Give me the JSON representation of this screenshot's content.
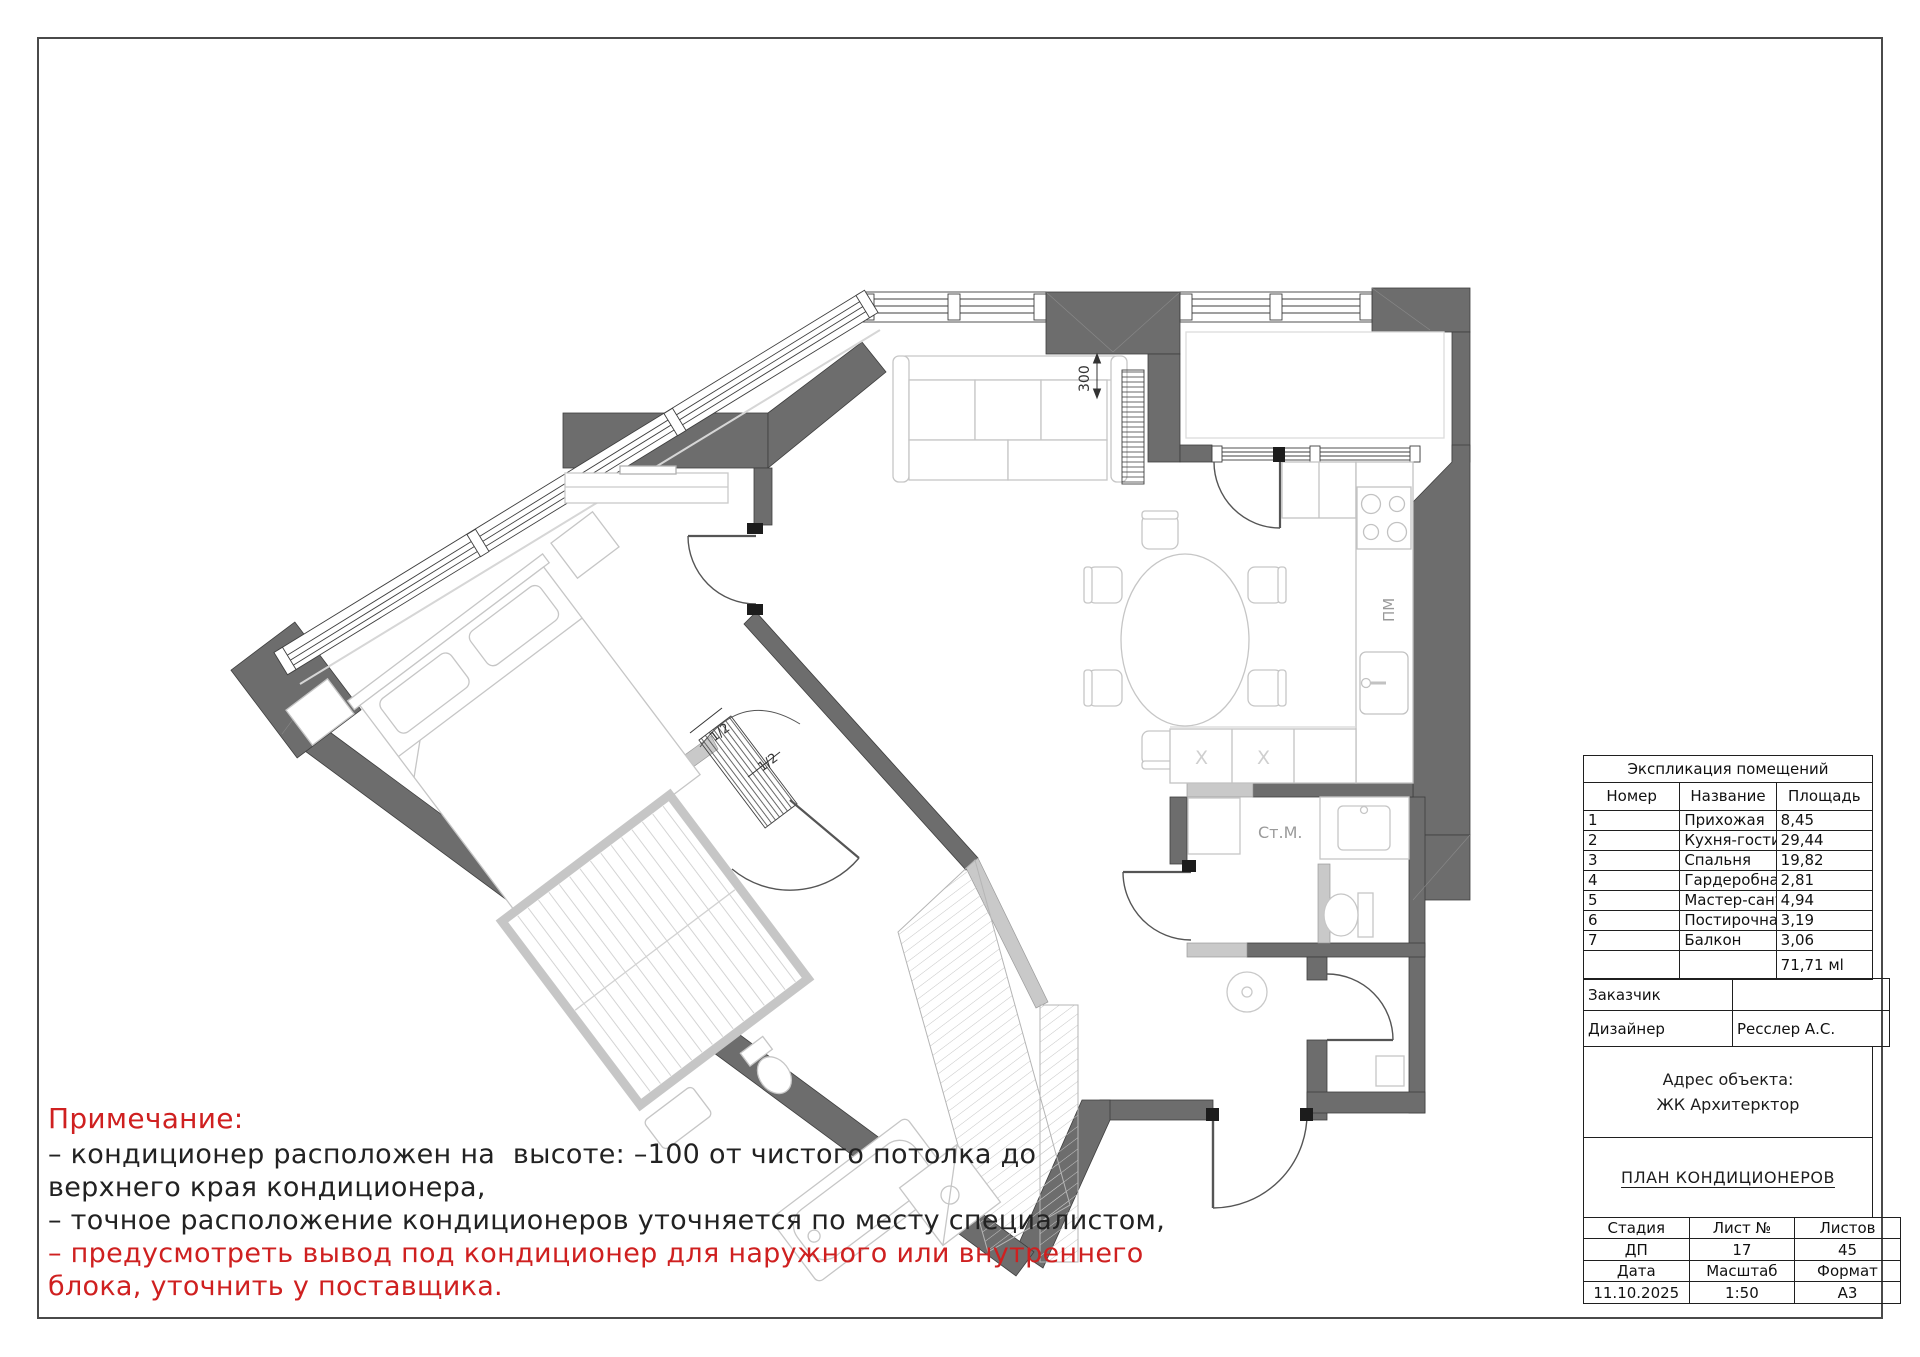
{
  "notes": {
    "title": "Примечание:",
    "lines": [
      "– кондиционер расположен на  высоте: –100 от чистого потолка до",
      "верхнего края кондиционера,",
      "– точное расположение кондиционеров уточняется по месту специалистом,",
      "– предусмотреть вывод под кондиционер для наружного или внутреннего",
      "блока, уточнить у поставщика."
    ]
  },
  "plan": {
    "labels": {
      "dim_300": "300",
      "dishwasher": "ПМ",
      "washing_machine": "Ст.М.",
      "x_mark": "X",
      "half": "1/2"
    },
    "colors": {
      "wall": "#6d6d6d",
      "light_wall": "#c9c9c9",
      "furniture": "#c6c6c6",
      "note_red": "#cf2020"
    }
  },
  "title_block": {
    "explication": {
      "title": "Экспликация помещений",
      "columns": [
        "Номер",
        "Название",
        "Площадь"
      ],
      "rows": [
        [
          "1",
          "Прихожая",
          "8,45"
        ],
        [
          "2",
          "Кухня-гостиная",
          "29,44"
        ],
        [
          "3",
          "Спальня",
          "19,82"
        ],
        [
          "4",
          "Гардеробная",
          "2,81"
        ],
        [
          "5",
          "Мастер-санузел",
          "4,94"
        ],
        [
          "6",
          "Постирочная",
          "3,19"
        ],
        [
          "7",
          "Балкон",
          "3,06"
        ]
      ],
      "total": "71,71 мl"
    },
    "customer_label": "Заказчик",
    "designer_label": "Дизайнер",
    "designer_value": "Ресслер А.С.",
    "address_label": "Адрес объекта:",
    "address_value": "ЖК Архитерктор",
    "drawing_title": "ПЛАН КОНДИЦИОНЕРОВ",
    "stage_label": "Стадия",
    "sheet_label": "Лист №",
    "sheets_label": "Листов",
    "stage": "ДП",
    "sheet": "17",
    "sheets": "45",
    "date_label": "Дата",
    "scale_label": "Масштаб",
    "format_label": "Формат",
    "date": "11.10.2025",
    "scale": "1:50",
    "format": "А3"
  }
}
